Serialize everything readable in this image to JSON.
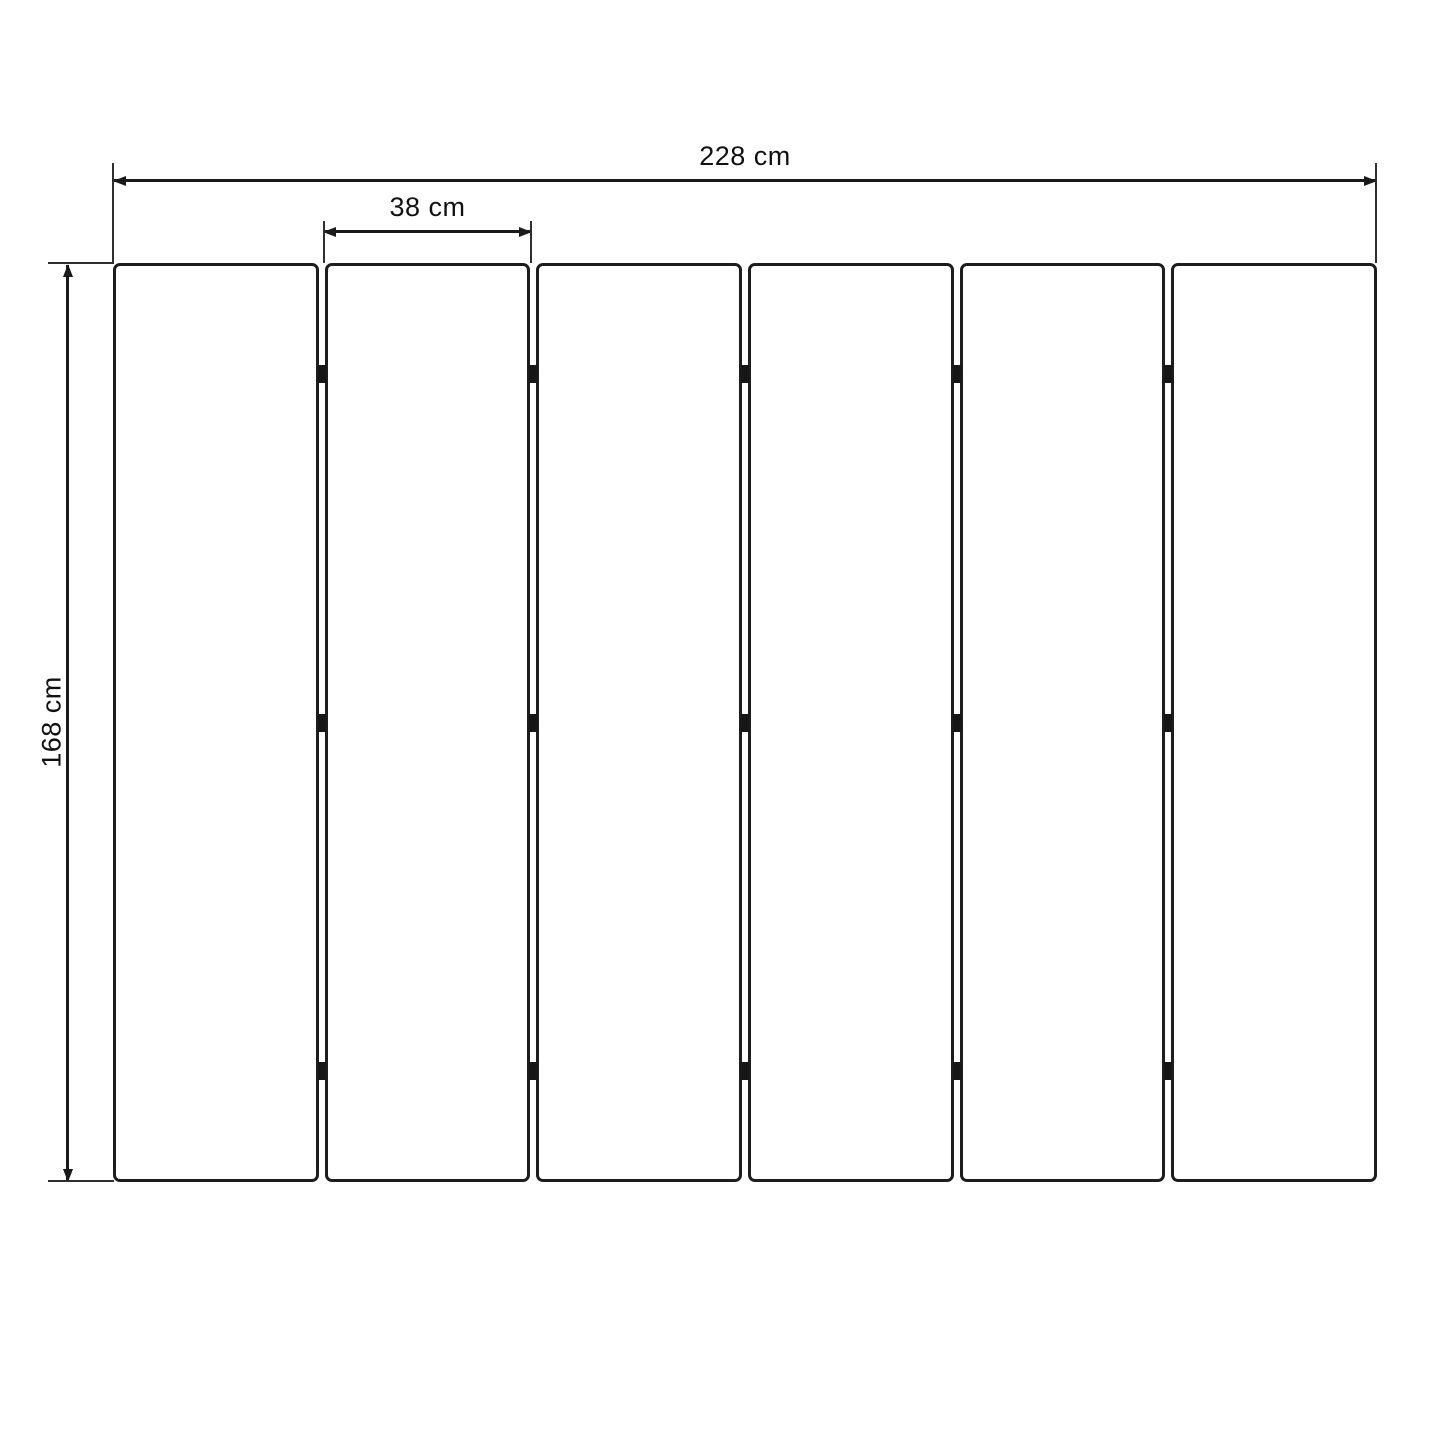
{
  "diagram": {
    "type": "dimension-drawing",
    "subject": "six-panel folding screen, front elevation",
    "dimensions": {
      "total_width": "228 cm",
      "panel_width": "38 cm",
      "height": "168 cm"
    },
    "panels": {
      "count": 6,
      "hinges_per_gap": 3,
      "hinge_positions_pct": [
        12.1,
        50,
        87.9
      ]
    },
    "colors": {
      "background": "#ffffff",
      "panel_border": "#1d1d1d",
      "dimension_line": "#1a1a1a",
      "extension_line": "#2f2f2f",
      "text": "#111111"
    }
  }
}
